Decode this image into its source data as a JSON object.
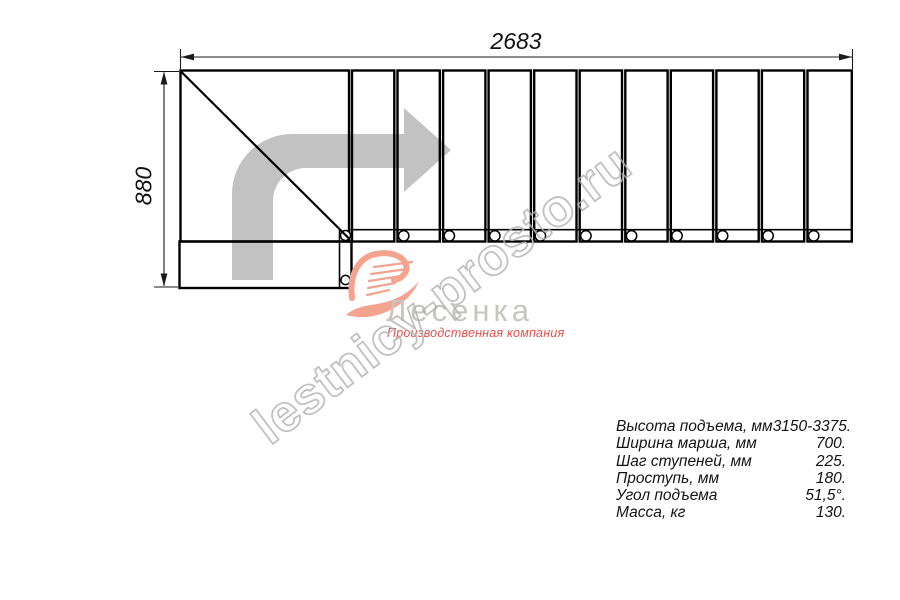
{
  "drawing": {
    "width_label": "2683",
    "height_label": "880",
    "treads_count": 11
  },
  "watermark": {
    "text": "lestnicy-prosto.ru"
  },
  "logo": {
    "name": "Лесенка",
    "tagline": "Производственная компания"
  },
  "specs": {
    "rows": [
      {
        "label": "Высота подъема, мм",
        "value": "3150-3375."
      },
      {
        "label": "Ширина марша, мм",
        "value": "700."
      },
      {
        "label": "Шаг ступеней, мм",
        "value": "225."
      },
      {
        "label": "Проступь, мм",
        "value": "180."
      },
      {
        "label": "Угол подъема",
        "value": "51,5°."
      },
      {
        "label": "Масса, кг",
        "value": "130."
      }
    ]
  },
  "colors": {
    "line": "#000000",
    "arrow": "#c2c2c2",
    "watermark": "#b2b2b2",
    "logo_swoosh": "#f4a38f",
    "logo_name": "#c8c5c0",
    "logo_tagline": "#e2524e"
  }
}
